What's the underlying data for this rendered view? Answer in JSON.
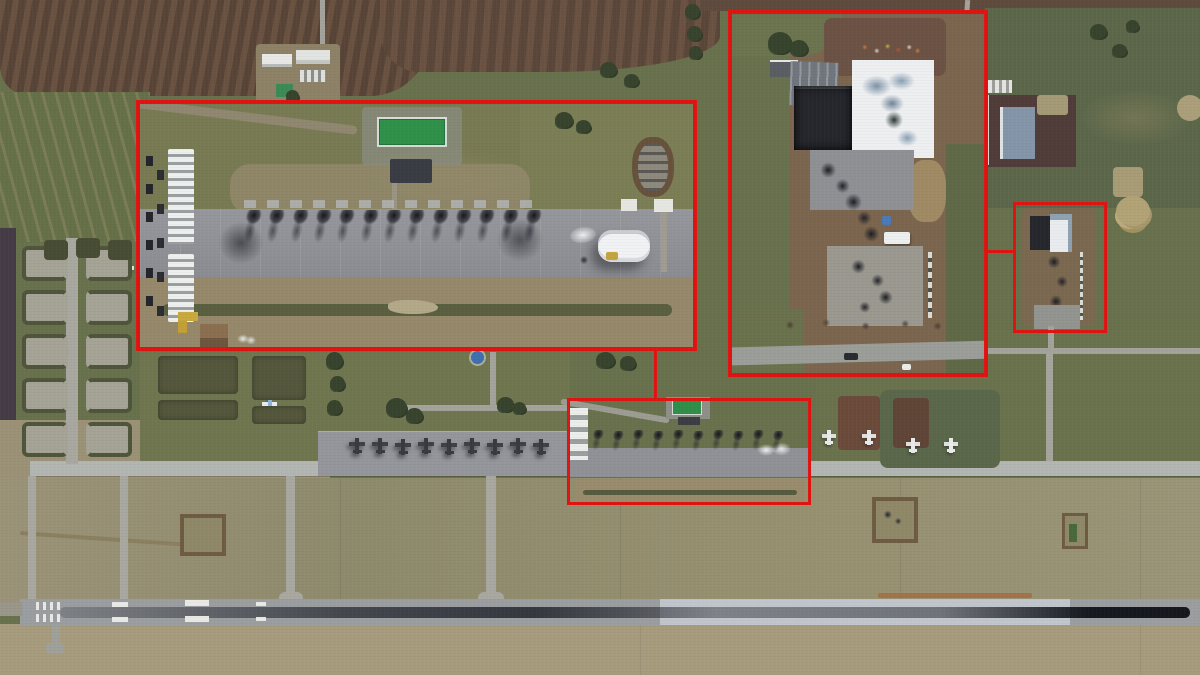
{
  "palette": {
    "accent_red": "#e01310",
    "grass_olive": "#68714c",
    "grass_scrub": "#5c674a",
    "grass_tan": "#9b9176",
    "field_brown": "#5e4a3c",
    "field_purple": "#453b46",
    "pavement": "#aeb1ad",
    "runway_gray": "#9b9ea0",
    "runway_light": "#c1c6cc",
    "rubber_streak": "#1c1e26",
    "apron_gray": "#92949a",
    "dirt_brown": "#7b654e",
    "building_white": "#edeff1",
    "roof_green": "#2f9149",
    "burn_black": "#1b1c22",
    "marking_white": "#e9eae6",
    "orange_scar": "#a86a40"
  },
  "annotations": {
    "inset-flightline": {
      "x": 136,
      "y": 100,
      "w": 561,
      "h": 251
    },
    "inset-buildings": {
      "x": 728,
      "y": 10,
      "w": 260,
      "h": 367
    },
    "target-box-flightline": {
      "x": 567,
      "y": 398,
      "w": 244,
      "h": 107
    },
    "target-box-buildings": {
      "x": 1013,
      "y": 202,
      "w": 94,
      "h": 131
    },
    "connector-flightline": {
      "x": 654,
      "y": 351,
      "w": 3,
      "h": 47
    },
    "connector-buildings": {
      "x": 988,
      "y": 250,
      "w": 25,
      "h": 3
    }
  },
  "sprites": [
    {
      "type": "jet-dark",
      "name": "parked-aircraft-icon",
      "x": 349,
      "y": 438
    },
    {
      "type": "jet-dark",
      "name": "parked-aircraft-icon",
      "x": 372,
      "y": 438
    },
    {
      "type": "jet-dark",
      "name": "parked-aircraft-icon",
      "x": 395,
      "y": 439
    },
    {
      "type": "jet-dark",
      "name": "parked-aircraft-icon",
      "x": 418,
      "y": 438
    },
    {
      "type": "jet-dark",
      "name": "parked-aircraft-icon",
      "x": 441,
      "y": 439
    },
    {
      "type": "jet-dark",
      "name": "parked-aircraft-icon",
      "x": 464,
      "y": 438
    },
    {
      "type": "jet-dark",
      "name": "parked-aircraft-icon",
      "x": 487,
      "y": 439
    },
    {
      "type": "jet-dark",
      "name": "parked-aircraft-icon",
      "x": 510,
      "y": 438
    },
    {
      "type": "jet-dark",
      "name": "parked-aircraft-icon",
      "x": 533,
      "y": 439
    },
    {
      "type": "burn-sm",
      "name": "burned-aircraft-icon",
      "x": 592,
      "y": 430
    },
    {
      "type": "burn-sm",
      "name": "burned-aircraft-icon",
      "x": 612,
      "y": 431
    },
    {
      "type": "burn-sm",
      "name": "burned-aircraft-icon",
      "x": 632,
      "y": 430
    },
    {
      "type": "burn-sm",
      "name": "burned-aircraft-icon",
      "x": 652,
      "y": 431
    },
    {
      "type": "burn-sm",
      "name": "burned-aircraft-icon",
      "x": 672,
      "y": 430
    },
    {
      "type": "burn-sm",
      "name": "burned-aircraft-icon",
      "x": 692,
      "y": 431
    },
    {
      "type": "burn-sm",
      "name": "burned-aircraft-icon",
      "x": 712,
      "y": 430
    },
    {
      "type": "burn-sm",
      "name": "burned-aircraft-icon",
      "x": 732,
      "y": 431
    },
    {
      "type": "burn-sm",
      "name": "burned-aircraft-icon",
      "x": 752,
      "y": 430
    },
    {
      "type": "burn-sm",
      "name": "burned-aircraft-icon",
      "x": 772,
      "y": 431
    },
    {
      "type": "jet-white",
      "name": "decoy-aircraft-icon",
      "x": 822,
      "y": 430
    },
    {
      "type": "jet-white",
      "name": "decoy-aircraft-icon",
      "x": 862,
      "y": 430
    },
    {
      "type": "jet-white",
      "name": "decoy-aircraft-icon",
      "x": 906,
      "y": 438
    },
    {
      "type": "jet-white",
      "name": "decoy-aircraft-icon",
      "x": 944,
      "y": 438
    },
    {
      "type": "jet-white",
      "name": "dispersal-aircraft-icon",
      "x": 54,
      "y": 344
    },
    {
      "type": "jet-blue",
      "name": "dispersal-aircraft-icon",
      "x": 94,
      "y": 340
    },
    {
      "type": "jet-white",
      "name": "dispersal-aircraft-icon",
      "x": 120,
      "y": 262
    },
    {
      "type": "jet-white",
      "name": "dispersal-aircraft-icon",
      "x": 172,
      "y": 374
    },
    {
      "type": "jet-white",
      "name": "dispersal-aircraft-icon",
      "x": 212,
      "y": 376
    },
    {
      "type": "jet-blue",
      "name": "dispersal-aircraft-icon",
      "x": 262,
      "y": 398
    },
    {
      "type": "revet-l",
      "name": "revetment",
      "x": 22,
      "y": 246,
      "w": 38,
      "h": 27
    },
    {
      "type": "revet-r",
      "name": "revetment",
      "x": 86,
      "y": 246,
      "w": 38,
      "h": 27
    },
    {
      "type": "revet-l",
      "name": "revetment",
      "x": 22,
      "y": 290,
      "w": 38,
      "h": 27
    },
    {
      "type": "revet-r",
      "name": "revetment",
      "x": 86,
      "y": 290,
      "w": 38,
      "h": 27
    },
    {
      "type": "revet-l",
      "name": "revetment",
      "x": 22,
      "y": 334,
      "w": 38,
      "h": 27
    },
    {
      "type": "revet-r",
      "name": "revetment",
      "x": 86,
      "y": 334,
      "w": 38,
      "h": 27
    },
    {
      "type": "revet-l",
      "name": "revetment",
      "x": 22,
      "y": 378,
      "w": 38,
      "h": 27
    },
    {
      "type": "revet-r",
      "name": "revetment",
      "x": 86,
      "y": 378,
      "w": 38,
      "h": 27
    },
    {
      "type": "revet-l",
      "name": "revetment",
      "x": 22,
      "y": 422,
      "w": 38,
      "h": 27
    },
    {
      "type": "revet-r",
      "name": "revetment",
      "x": 86,
      "y": 422,
      "w": 38,
      "h": 27
    },
    {
      "type": "berm-dark",
      "name": "revetment-berm",
      "x": 44,
      "y": 240,
      "w": 24,
      "h": 20
    },
    {
      "type": "berm-dark",
      "name": "revetment-berm",
      "x": 76,
      "y": 238,
      "w": 24,
      "h": 20
    },
    {
      "type": "berm-dark",
      "name": "revetment-berm",
      "x": 108,
      "y": 240,
      "w": 24,
      "h": 20
    },
    {
      "type": "berm-block",
      "name": "revetment-berm",
      "x": 158,
      "y": 356,
      "w": 80,
      "h": 38
    },
    {
      "type": "berm-block",
      "name": "revetment-berm",
      "x": 252,
      "y": 356,
      "w": 54,
      "h": 44
    },
    {
      "type": "berm-block",
      "name": "revetment-berm",
      "x": 158,
      "y": 400,
      "w": 80,
      "h": 20
    },
    {
      "type": "berm-block",
      "name": "revetment-berm",
      "x": 252,
      "y": 406,
      "w": 54,
      "h": 18
    },
    {
      "type": "tree",
      "name": "tree-icon",
      "x": 326,
      "y": 352,
      "w": 17,
      "h": 17
    },
    {
      "type": "tree",
      "name": "tree-icon",
      "x": 330,
      "y": 376,
      "w": 15,
      "h": 15
    },
    {
      "type": "tree",
      "name": "tree-icon",
      "x": 327,
      "y": 400,
      "w": 15,
      "h": 15
    },
    {
      "type": "tree",
      "name": "tree-icon",
      "x": 386,
      "y": 398,
      "w": 21,
      "h": 19
    },
    {
      "type": "tree",
      "name": "tree-icon",
      "x": 406,
      "y": 408,
      "w": 17,
      "h": 15
    },
    {
      "type": "tree",
      "name": "tree-icon",
      "x": 497,
      "y": 397,
      "w": 17,
      "h": 15
    },
    {
      "type": "tree",
      "name": "tree-icon",
      "x": 513,
      "y": 402,
      "w": 13,
      "h": 12
    },
    {
      "type": "tree",
      "name": "tree-icon",
      "x": 685,
      "y": 4,
      "w": 15,
      "h": 15
    },
    {
      "type": "tree",
      "name": "tree-icon",
      "x": 687,
      "y": 26,
      "w": 15,
      "h": 15
    },
    {
      "type": "tree",
      "name": "tree-icon",
      "x": 689,
      "y": 46,
      "w": 13,
      "h": 13
    },
    {
      "type": "tree",
      "name": "tree-icon",
      "x": 596,
      "y": 352,
      "w": 19,
      "h": 16
    },
    {
      "type": "tree",
      "name": "tree-icon",
      "x": 620,
      "y": 356,
      "w": 16,
      "h": 14
    },
    {
      "type": "tree",
      "name": "tree-icon",
      "x": 600,
      "y": 62,
      "w": 17,
      "h": 15
    },
    {
      "type": "tree",
      "name": "tree-icon",
      "x": 624,
      "y": 74,
      "w": 15,
      "h": 13
    },
    {
      "type": "tree",
      "name": "tree-icon",
      "x": 1090,
      "y": 24,
      "w": 17,
      "h": 15
    },
    {
      "type": "tree",
      "name": "tree-icon",
      "x": 1112,
      "y": 44,
      "w": 15,
      "h": 13
    },
    {
      "type": "tree",
      "name": "tree-icon",
      "x": 1126,
      "y": 20,
      "w": 13,
      "h": 12
    },
    {
      "type": "tree-tan",
      "name": "dead-tree-icon",
      "x": 1116,
      "y": 196,
      "w": 34,
      "h": 30
    }
  ],
  "inset_flightline_burn_row": {
    "y": 106,
    "xs": [
      104,
      127,
      151,
      174,
      197,
      221,
      244,
      267,
      291,
      314,
      337,
      361,
      384
    ]
  },
  "counts": {
    "burned_aircraft_inset": 13,
    "burned_aircraft_flightline": 10,
    "parked_aircraft_apron": 9,
    "decoy_aircraft": 4
  }
}
